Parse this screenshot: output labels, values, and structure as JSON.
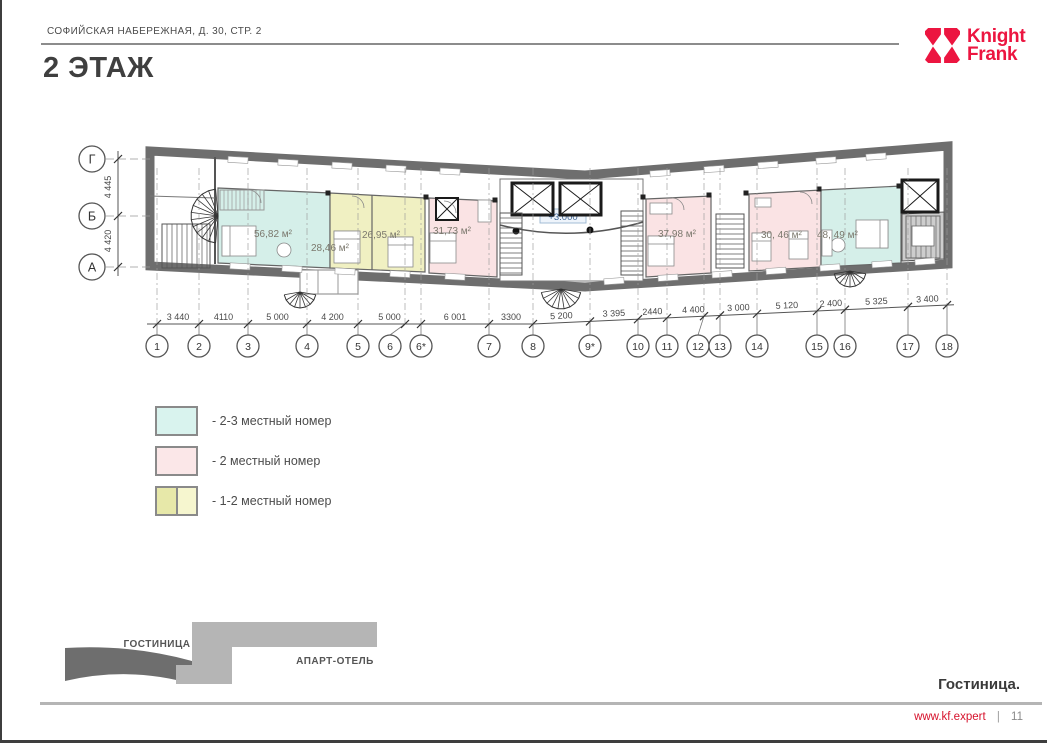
{
  "header": {
    "address": "СОФИЙСКАЯ НАБЕРЕЖНАЯ, Д. 30, СТР. 2",
    "title": "2 ЭТАЖ"
  },
  "logo": {
    "line1": "Knight",
    "line2": "Frank",
    "color": "#ec1540"
  },
  "plan": {
    "level_mark": "+3.000",
    "rooms": [
      {
        "area": "56,82 м²",
        "type": "2-3 местный номер"
      },
      {
        "area": "28,46 м²",
        "type": "1-2 местный номер"
      },
      {
        "area": "26,95 м²",
        "type": "1-2 местный номер"
      },
      {
        "area": "31,73 м²",
        "type": "2 местный номер"
      },
      {
        "area": "37,98 м²",
        "type": "2 местный номер"
      },
      {
        "area": "30, 46 м²",
        "type": "2 местный номер"
      },
      {
        "area": "48, 49 м²",
        "type": "2-3 местный номер"
      }
    ],
    "axes_bottom": [
      "1",
      "2",
      "3",
      "4",
      "5",
      "6",
      "6*",
      "7",
      "8",
      "9*",
      "10",
      "11",
      "12",
      "13",
      "14",
      "15",
      "16",
      "17",
      "18"
    ],
    "dims_bottom": [
      "3 440",
      "4110",
      "5 000",
      "4 200",
      "5 000",
      "6 001",
      "3300",
      "5 200",
      "3 395",
      "2440",
      "4 400",
      "3 000",
      "5 120",
      "2 400",
      "5 325",
      "3 400"
    ],
    "axes_left": [
      "Г",
      "Б",
      "А"
    ],
    "dims_left": [
      "4 445",
      "4 420"
    ],
    "colors": {
      "room_23": "#d5efe9",
      "room_2": "#fae3e4",
      "room_12": "#f0f0c2",
      "wall": "#6e6e6e",
      "stair_fill": "#cdcdcd"
    }
  },
  "legend": {
    "items": [
      {
        "label": "- 2-3 местный номер",
        "color": "#d9f3ee"
      },
      {
        "label": "- 2 местный номер",
        "color": "#fbe7e8"
      },
      {
        "label": "- 1-2 местный номер",
        "color": "#e7e8a9",
        "color2": "#f6f6cf"
      }
    ]
  },
  "site_map": {
    "hotel_label": "ГОСТИНИЦА",
    "apart_label": "АПАРТ-ОТЕЛЬ"
  },
  "footer": {
    "caption": "Гостиница.",
    "site": "www.kf.expert",
    "separator": "|",
    "page_number": "11"
  }
}
